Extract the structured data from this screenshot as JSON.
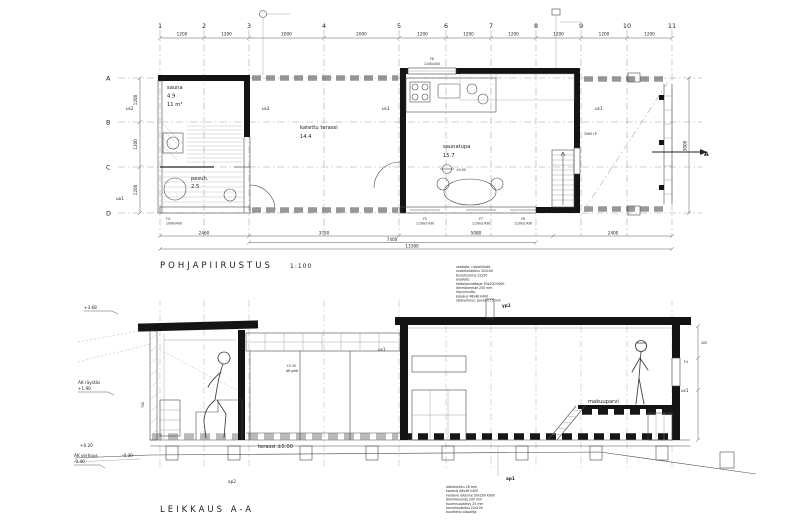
{
  "drawing": {
    "plan": {
      "title": "POHJAPIIRUSTUS",
      "scale": "1:100",
      "grid_cols": [
        "1",
        "2",
        "3",
        "4",
        "5",
        "6",
        "7",
        "8",
        "9",
        "10",
        "11"
      ],
      "col_dims": [
        "1200",
        "1200",
        "2000",
        "2000",
        "1200",
        "1200",
        "1200",
        "1200",
        "1200",
        "1200"
      ],
      "grid_rows": [
        "A",
        "B",
        "C",
        "D"
      ],
      "row_dims": [
        "1200",
        "1200",
        "1200"
      ],
      "rooms": {
        "sauna": {
          "name": "sauna",
          "area": "4.9",
          "volume": "11 m³"
        },
        "pesuhuone": {
          "name": "pesuh.",
          "area": "2.5"
        },
        "terassi": {
          "name": "katettu terassi",
          "area": "14.4"
        },
        "saunatupa": {
          "name": "saunatupa",
          "area": "15.7",
          "level": "±0.00"
        }
      },
      "wall_labels": {
        "us1_left": "us1",
        "us1_right": "us1",
        "us2_left": "us2",
        "us2_right": "us2",
        "uo1": "uo1",
        "lp": "3060 LP"
      },
      "windows": {
        "f4": {
          "id": "F4",
          "size": "1090x400"
        },
        "f6": {
          "id": "F6",
          "size": "1100x400"
        },
        "f5": {
          "id": "F5",
          "size": "1130x1430"
        },
        "f7": {
          "id": "F7",
          "size": "1130x1430"
        },
        "f8": {
          "id": "F8",
          "size": "1130x1430"
        }
      },
      "dims_bottom": {
        "d1": "2460",
        "d2": "3750",
        "d3": "5080",
        "d4": "2400",
        "d5": "7400",
        "total": "13380"
      },
      "dim_right": "3000",
      "section_mark": "A"
    },
    "section": {
      "title": "LEIKKAUS A-A",
      "labels": {
        "terassi": "terassi ±0.00",
        "makuuparvi": "makuuparvi",
        "ap1": "ap1",
        "ap2": "ap2",
        "yp1": "yp1",
        "us1_a": "us1",
        "us1_b": "us1",
        "ak_pelti": "AK pelti",
        "ak_pelti_level": "+0.30",
        "f4": "F4"
      },
      "elevations": {
        "e1": "+3.68",
        "e2": "AK räystäs",
        "e2v": "+1.90",
        "e3": "+0.20",
        "e4": "AK verhous",
        "e4v": "-0.40",
        "e5": "-0.30",
        "d700": "700",
        "d400": "400"
      },
      "yp1_spec": [
        "vesikate, rivipeltikate",
        "ruodelaudoitus 32x100",
        "tuuletusrima 22x50",
        "aluskate",
        "kattokannattajat 50x200 k900",
        "lämmöneriste 200 mm",
        "höyrynsulku",
        "koolaus 48x48 k400",
        "sisäverhous, paneeli 15 mm"
      ],
      "ap1_spec": [
        "lattialankku 28 mm",
        "koolaus 48x48 k400",
        "kantava rakenne 50x200 k600",
        "lämmöneriste 200 mm",
        "tuulensuojalevy 25 mm",
        "harvalaudoitus 22x100",
        "tuuletettu alapohja"
      ]
    }
  }
}
